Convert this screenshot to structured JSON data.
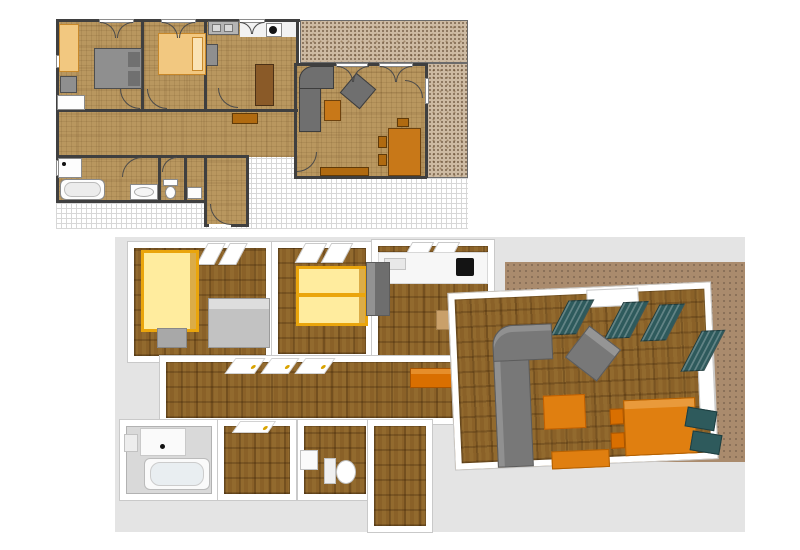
{
  "palette": {
    "page_bg": "#ffffff",
    "plan2d_floor": "#b9975f",
    "plan2d_wall": "#3f3f3f",
    "plan2d_terrace": "#cdbaa2",
    "plan2d_kitchen_white": "#f2f2f2",
    "furn_gray": "#8f8f8f",
    "furn_gray_dark": "#6f6f6f",
    "pillow_gray": "#707070",
    "furn_orange_light": "#f2c880",
    "furn_orange": "#c87818",
    "furn_orange_deep": "#b06a10",
    "wood_brown": "#8a5a28",
    "view3d_panel": "#e4e4e4",
    "view3d_carpet": "#8a6128",
    "view3d_terrace": "#aa8b6d",
    "view3d_wall": "#ffffff",
    "bath_floor_3d": "#d9d9d9",
    "yellow_fill": "#ffec9e",
    "yellow_frame": "#eaa50c",
    "orange_3d": "#e07f10",
    "orange_3d_deep": "#d96f00",
    "tan_table": "#c9a06a",
    "teal_curtain": "#2e5a5c",
    "fixture_white": "#fafafa",
    "fridge_gray": "#6e6e6e",
    "bed_gray_3d": "#c2c2c2",
    "cooktop_black": "#141414"
  },
  "plan_2d": {
    "name": "2d-floor-plan",
    "rooms": [
      {
        "name": "bedroom-1",
        "furniture": [
          "wardrobe",
          "dresser",
          "double-bed-with-pillows",
          "low-window"
        ]
      },
      {
        "name": "bedroom-2",
        "furniture": [
          "single-bed"
        ]
      },
      {
        "name": "kitchen",
        "furniture": [
          "sink-counter",
          "tall-cabinet",
          "cooker",
          "kitchen-table"
        ]
      },
      {
        "name": "living-room",
        "furniture": [
          "corner-sofa",
          "armchair",
          "coffee-table",
          "dining-table",
          "dining-chairs",
          "sideboard"
        ]
      },
      {
        "name": "hallway",
        "furniture": [
          "sideboard"
        ]
      },
      {
        "name": "bathroom",
        "furniture": [
          "washbasin-counter",
          "bathtub",
          "oval-washbasin"
        ]
      },
      {
        "name": "wc",
        "furniture": [
          "toilet"
        ]
      },
      {
        "name": "storage-room",
        "furniture": [
          "hand-basin"
        ]
      },
      {
        "name": "entrance-corridor",
        "furniture": [
          "entrance-door"
        ]
      }
    ],
    "outdoor": [
      "terrace-top",
      "terrace-right",
      "grid-paper-ground"
    ],
    "symbols": [
      "door-swing-arcs",
      "french-window-arcs",
      "wall-window-gaps"
    ]
  },
  "view_3d": {
    "name": "3d-floor-plan-render",
    "rooms": [
      {
        "name": "bedroom-1",
        "furniture": [
          "yellow-wardrobe",
          "gray-nightstand",
          "gray-bed",
          "window-panes"
        ]
      },
      {
        "name": "bedroom-2",
        "furniture": [
          "yellow-bunk-bed",
          "window-panes"
        ]
      },
      {
        "name": "kitchen",
        "furniture": [
          "white-counter",
          "cooktop",
          "fridge",
          "kitchen-table",
          "orange-bench",
          "window-panes"
        ]
      },
      {
        "name": "hallway",
        "furniture": [
          "open-white-doors",
          "orange-sideboard"
        ]
      },
      {
        "name": "living-room",
        "furniture": [
          "corner-sofa",
          "armchair",
          "coffee-table",
          "dining-table",
          "orange-chairs",
          "teal-chairs",
          "sideboard",
          "teal-curtains",
          "windows"
        ]
      },
      {
        "name": "bathroom",
        "furniture": [
          "washbasin-counter",
          "bathtub",
          "small-fixture"
        ]
      },
      {
        "name": "dressing-room",
        "furniture": [
          "open-white-door"
        ]
      },
      {
        "name": "wc",
        "furniture": [
          "washbasin",
          "toilet"
        ]
      },
      {
        "name": "entrance-corridor",
        "furniture": []
      }
    ],
    "outdoor": [
      "tiled-terrace"
    ]
  }
}
